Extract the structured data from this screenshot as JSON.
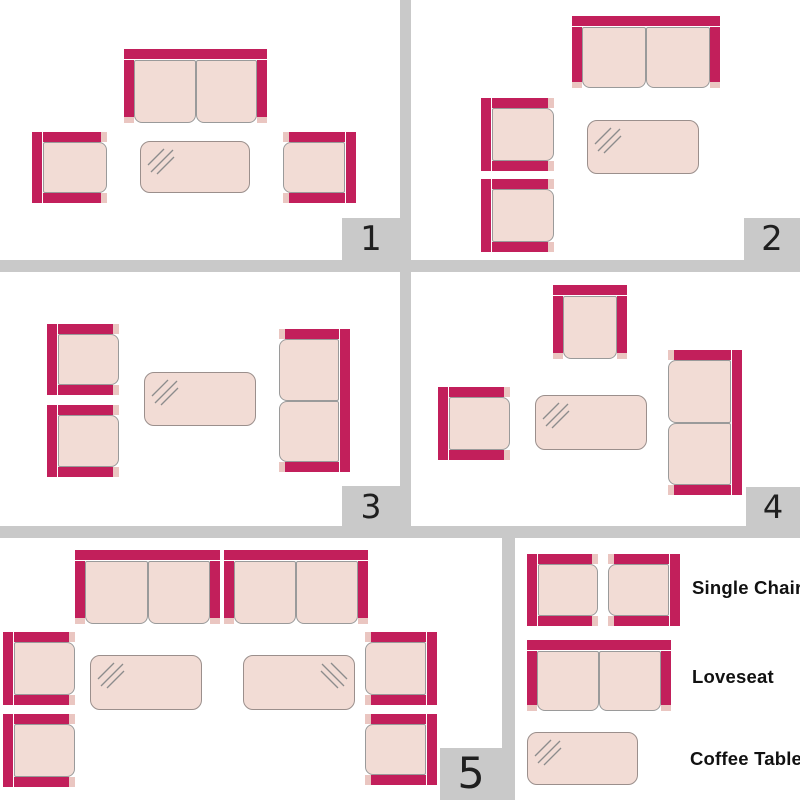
{
  "colors": {
    "frame": "#c21f5b",
    "cushion": "#f2dcd5",
    "cushion_border": "#9a9a9a",
    "arm_cap": "#eac6c1",
    "table_border": "#9b8f8c",
    "shine": "#8c8c8c",
    "gutter": "#c9c9c9",
    "badge_bg": "#c9c9c9",
    "badge_text": "#1f1f1f",
    "label_text": "#111111",
    "background": "#ffffff"
  },
  "gutters": [
    {
      "x": 400,
      "y": 0,
      "w": 11,
      "h": 538
    },
    {
      "x": 0,
      "y": 260,
      "w": 800,
      "h": 12
    },
    {
      "x": 0,
      "y": 526,
      "w": 800,
      "h": 12
    },
    {
      "x": 502,
      "y": 538,
      "w": 13,
      "h": 262
    }
  ],
  "panels": [
    {
      "number": "1",
      "badge": {
        "x": 342,
        "y": 218,
        "w": 58,
        "h": 42
      },
      "pieces": [
        {
          "type": "loveseat",
          "facing": "down",
          "x": 124,
          "y": 49,
          "w": 143,
          "h": 74
        },
        {
          "type": "chair",
          "facing": "right",
          "x": 32,
          "y": 132,
          "w": 75,
          "h": 71
        },
        {
          "type": "table",
          "shine": "tl",
          "x": 140,
          "y": 141,
          "w": 110,
          "h": 52
        },
        {
          "type": "chair",
          "facing": "left",
          "x": 283,
          "y": 132,
          "w": 73,
          "h": 71
        }
      ]
    },
    {
      "number": "2",
      "badge": {
        "x": 744,
        "y": 218,
        "w": 56,
        "h": 42
      },
      "pieces": [
        {
          "type": "loveseat",
          "facing": "down",
          "x": 572,
          "y": 16,
          "w": 148,
          "h": 72
        },
        {
          "type": "chair",
          "facing": "right",
          "x": 481,
          "y": 98,
          "w": 73,
          "h": 73
        },
        {
          "type": "chair",
          "facing": "right",
          "x": 481,
          "y": 179,
          "w": 73,
          "h": 73
        },
        {
          "type": "table",
          "shine": "tl",
          "x": 587,
          "y": 120,
          "w": 112,
          "h": 54
        }
      ]
    },
    {
      "number": "3",
      "badge": {
        "x": 342,
        "y": 486,
        "w": 58,
        "h": 40
      },
      "pieces": [
        {
          "type": "chair",
          "facing": "right",
          "x": 47,
          "y": 324,
          "w": 72,
          "h": 71
        },
        {
          "type": "chair",
          "facing": "right",
          "x": 47,
          "y": 405,
          "w": 72,
          "h": 72
        },
        {
          "type": "table",
          "shine": "tl",
          "x": 144,
          "y": 372,
          "w": 112,
          "h": 54
        },
        {
          "type": "loveseat",
          "facing": "left",
          "x": 279,
          "y": 329,
          "w": 71,
          "h": 143
        }
      ]
    },
    {
      "number": "4",
      "badge": {
        "x": 746,
        "y": 487,
        "w": 54,
        "h": 39
      },
      "pieces": [
        {
          "type": "chair",
          "facing": "down",
          "x": 553,
          "y": 285,
          "w": 74,
          "h": 74
        },
        {
          "type": "chair",
          "facing": "right",
          "x": 438,
          "y": 387,
          "w": 72,
          "h": 73
        },
        {
          "type": "table",
          "shine": "tl",
          "x": 535,
          "y": 395,
          "w": 112,
          "h": 55
        },
        {
          "type": "loveseat",
          "facing": "left",
          "x": 668,
          "y": 350,
          "w": 74,
          "h": 145
        }
      ]
    },
    {
      "number": "5",
      "badge": {
        "x": 440,
        "y": 748,
        "w": 62,
        "h": 52
      },
      "pieces": [
        {
          "type": "loveseat",
          "facing": "down",
          "x": 75,
          "y": 550,
          "w": 145,
          "h": 74
        },
        {
          "type": "loveseat",
          "facing": "down",
          "x": 224,
          "y": 550,
          "w": 144,
          "h": 74
        },
        {
          "type": "chair",
          "facing": "right",
          "x": 3,
          "y": 632,
          "w": 72,
          "h": 73
        },
        {
          "type": "chair",
          "facing": "right",
          "x": 3,
          "y": 714,
          "w": 72,
          "h": 73
        },
        {
          "type": "chair",
          "facing": "left",
          "x": 365,
          "y": 632,
          "w": 72,
          "h": 73
        },
        {
          "type": "chair",
          "facing": "left",
          "x": 365,
          "y": 714,
          "w": 72,
          "h": 71
        },
        {
          "type": "table",
          "shine": "tl",
          "x": 90,
          "y": 655,
          "w": 112,
          "h": 55
        },
        {
          "type": "table",
          "shine": "tr",
          "x": 243,
          "y": 655,
          "w": 112,
          "h": 55
        }
      ]
    }
  ],
  "legend": {
    "items": [
      {
        "id": "single-chair",
        "label": "Single Chair"
      },
      {
        "id": "loveseat",
        "label": "Loveseat"
      },
      {
        "id": "coffee-table",
        "label": "Coffee Table"
      }
    ],
    "pieces": [
      {
        "type": "chair",
        "facing": "right",
        "x": 527,
        "y": 554,
        "w": 71,
        "h": 72
      },
      {
        "type": "chair",
        "facing": "left",
        "x": 608,
        "y": 554,
        "w": 72,
        "h": 72
      },
      {
        "type": "loveseat",
        "facing": "down",
        "x": 527,
        "y": 640,
        "w": 144,
        "h": 71
      },
      {
        "type": "table",
        "shine": "tl",
        "x": 527,
        "y": 732,
        "w": 111,
        "h": 53
      }
    ]
  }
}
